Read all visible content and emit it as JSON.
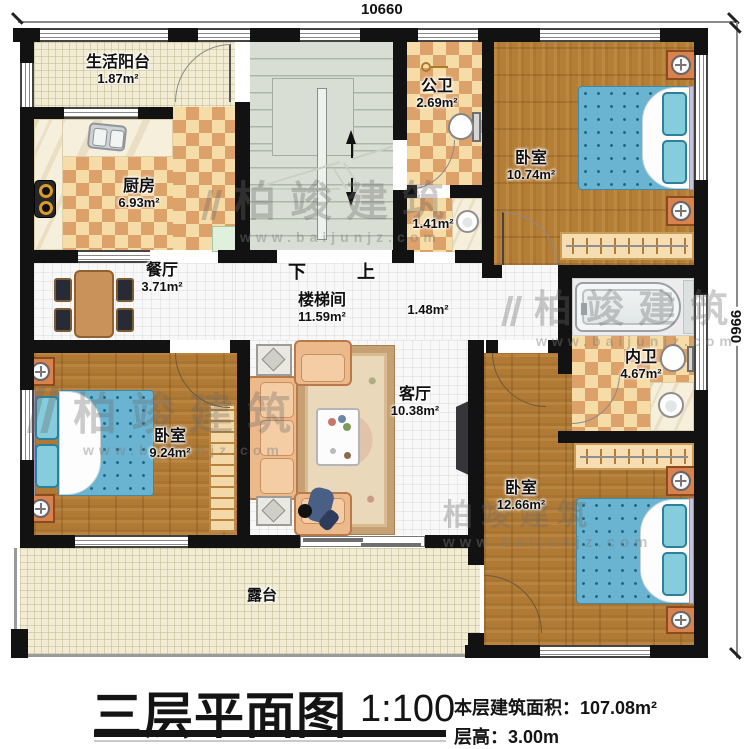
{
  "dimensions": {
    "width_label": "10660",
    "height_label": "9960"
  },
  "rooms": {
    "living_balcony": {
      "name": "生活阳台",
      "area": "1.87m²"
    },
    "kitchen": {
      "name": "厨房",
      "area": "6.93m²"
    },
    "dining": {
      "name": "餐厅",
      "area": "3.71m²"
    },
    "stairwell": {
      "name": "楼梯间",
      "area": "11.59m²"
    },
    "public_bath": {
      "name": "公卫",
      "area": "2.69m²"
    },
    "bath_lobby": {
      "area": "1.41m²"
    },
    "bedroom_ne": {
      "name": "卧室",
      "area": "10.74m²"
    },
    "hallway": {
      "area": "1.48m²"
    },
    "inner_bath": {
      "name": "内卫",
      "area": "4.67m²"
    },
    "bedroom_w": {
      "name": "卧室",
      "area": "9.24m²"
    },
    "living_room": {
      "name": "客厅",
      "area": "10.38m²"
    },
    "bedroom_se": {
      "name": "卧室",
      "area": "12.66m²"
    },
    "terrace": {
      "name": "露台"
    }
  },
  "stairs": {
    "down_label": "下",
    "up_label": "上"
  },
  "watermark": {
    "brand": "柏竣建筑",
    "url": "www.baijunjz.com"
  },
  "title_block": {
    "title": "三层平面图",
    "scale": "1:100",
    "area_label": "本层建筑面积：",
    "area_value": "107.08m²",
    "height_label": "层高：",
    "height_value": "3.00m"
  },
  "colors": {
    "wall": "#121212",
    "checker_light": "#f6dca6",
    "checker_dark": "#dda269",
    "wood": "#b17a34",
    "mattress_blue": "#6ab4d2",
    "stair_floor": "#d8ded4",
    "balcony_cream": "#f1ecd3",
    "nightstand_orange": "#d9824d"
  }
}
